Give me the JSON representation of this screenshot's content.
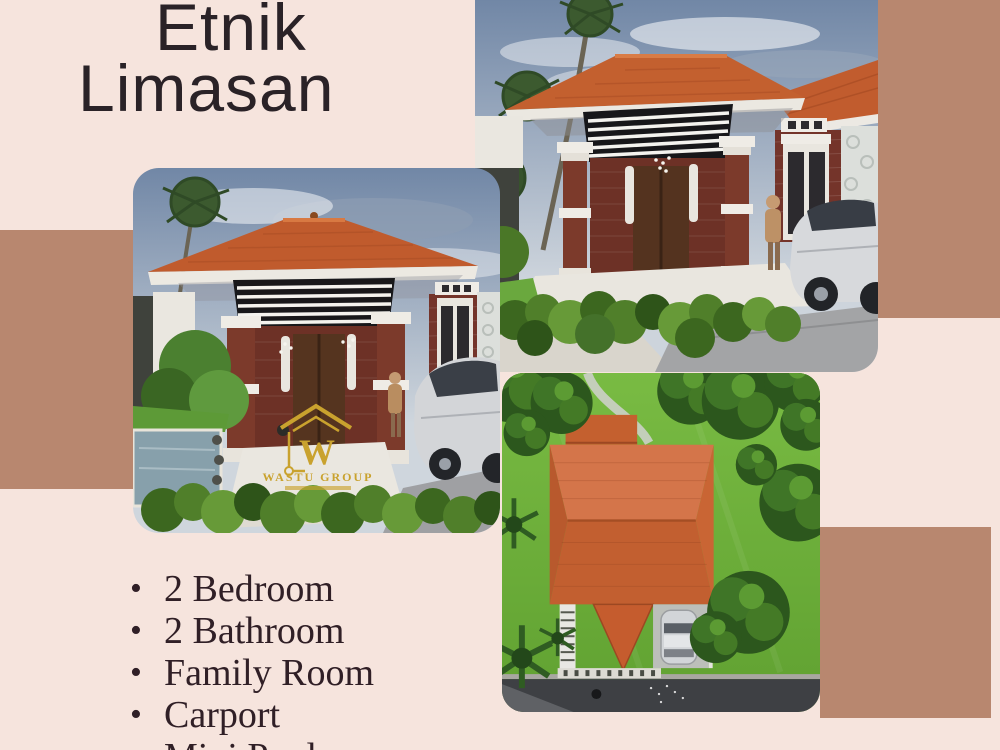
{
  "canvas": {
    "width": 1000,
    "height": 750
  },
  "palette": {
    "background_pink": "#f6e4dd",
    "accent_mauve": "#b8876f",
    "title_text": "#2a2227",
    "list_text": "#301f26",
    "roof_terracotta": "#c4602f",
    "brick": "#74342a",
    "foliage_green": "#4a7d2a",
    "lawn_green": "#6db03a",
    "sky_blue_grey": "#7187a6",
    "watermark_gold": "#c9a22e",
    "car_silver": "#d6d8da",
    "road_grey": "#3e4044"
  },
  "title": {
    "line1": "Etnik",
    "line2": "Limasan"
  },
  "features": {
    "bullet": "•",
    "items": [
      "2 Bedroom",
      "2 Bathroom",
      "Family Room",
      "Carport",
      "Mini Pool"
    ]
  },
  "watermark": {
    "brand": "WASTU GROUP"
  },
  "images": {
    "front_main": {
      "alt": "3D render front view: ethnic limasan house, terracotta hip roof, black louvre gable, brick pillars, dark wood door, hedge, person and silver car"
    },
    "front_secondary": {
      "alt": "3D render front view: limasan house with mini pool, hedge, silver car and Wastu Group watermark"
    },
    "aerial": {
      "alt": "3D render aerial top view: terracotta roof, bright lawn, trees, carport with car, road at bottom"
    }
  }
}
